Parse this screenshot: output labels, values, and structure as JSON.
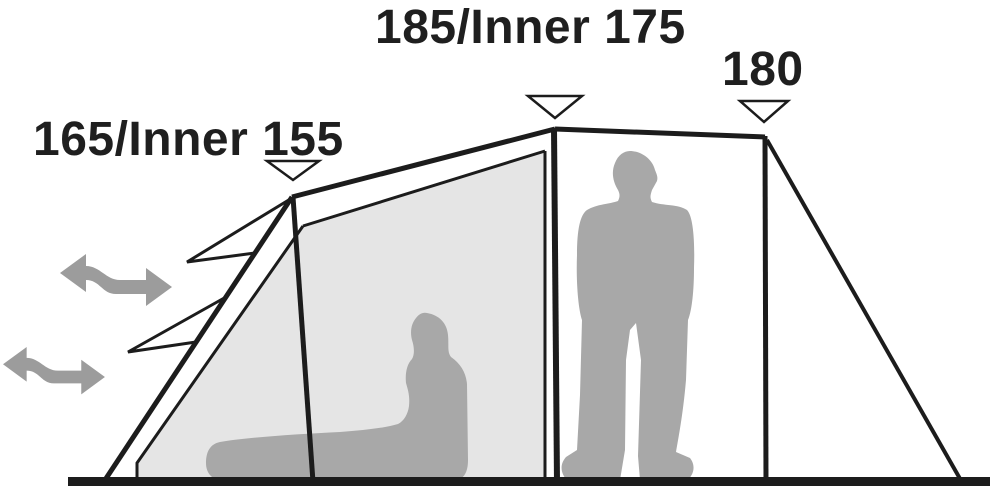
{
  "diagram": {
    "measurements": {
      "left_peak": {
        "label": "165/Inner 155"
      },
      "middle_peak": {
        "label": "185/Inner 175"
      },
      "right_peak": {
        "label": "180"
      }
    },
    "colors": {
      "background": "#ffffff",
      "outline": "#1c1c1c",
      "inner_panel": "#e5e5e5",
      "silhouette": "#a8a8a8",
      "airflow_arrow": "#9c9c9c",
      "marker_fill": "#ffffff"
    },
    "icons": {
      "airflow": "double-headed-wavy-arrow",
      "height_marker": "downward-triangle"
    }
  }
}
